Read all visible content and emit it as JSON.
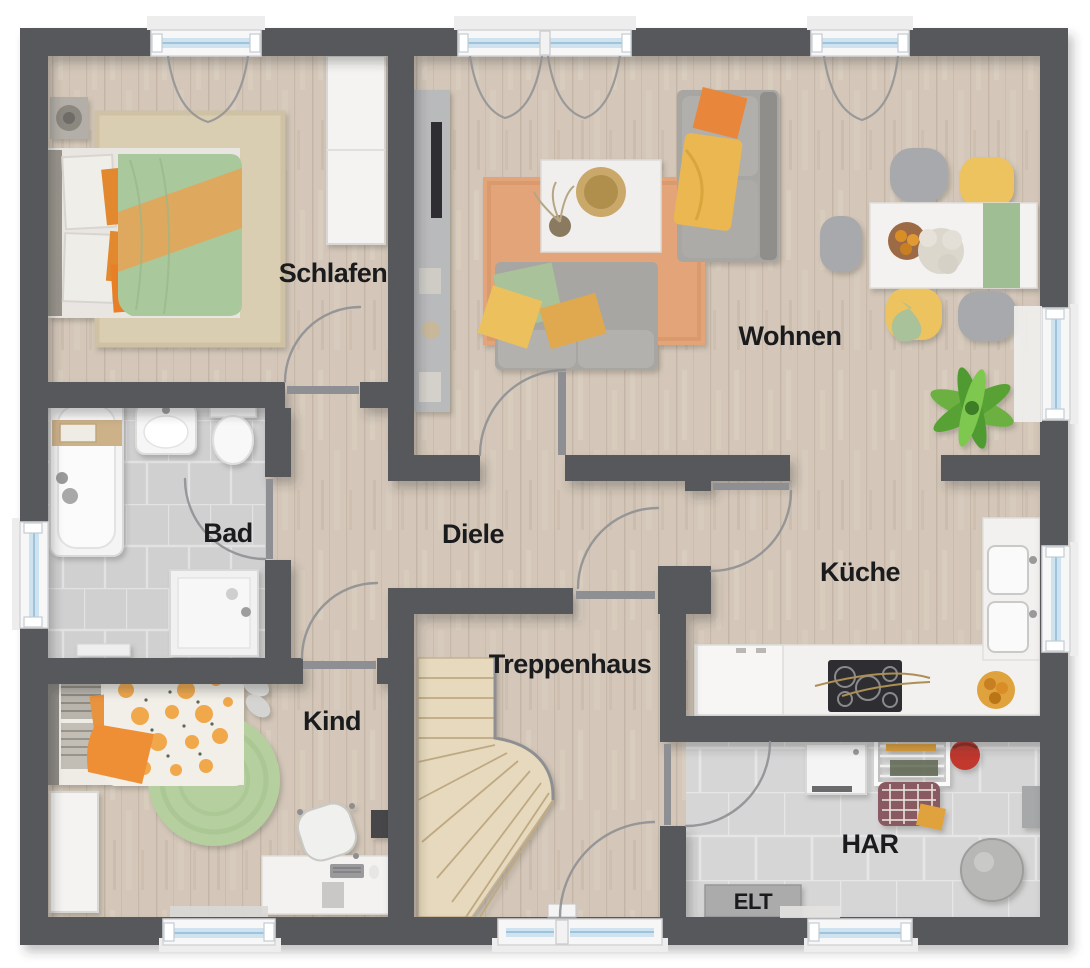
{
  "rooms": {
    "schlafen": "Schlafen",
    "wohnen": "Wohnen",
    "bad": "Bad",
    "diele": "Diele",
    "kueche": "Küche",
    "kind": "Kind",
    "treppenhaus": "Treppenhaus",
    "har": "HAR",
    "elt": "ELT"
  },
  "colors": {
    "wall": "#57585c",
    "wood_floor": "#d8ccbe",
    "bath_tile": "#d4d5d7",
    "utility_tile": "#dbdcde",
    "stair_wood": "#e6d9bd",
    "window_glass": "#cfe2f0",
    "accent_orange": "#e8873a",
    "accent_yellow": "#ecc05c",
    "accent_green": "#a9c89b",
    "label_text": "#1a1b1d"
  }
}
